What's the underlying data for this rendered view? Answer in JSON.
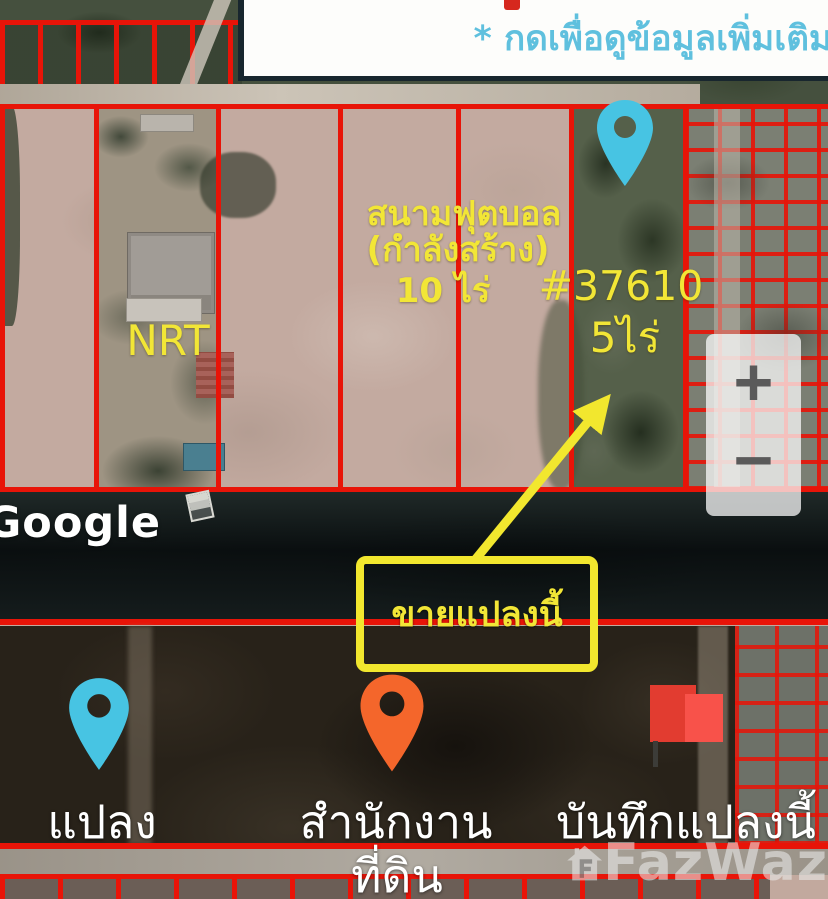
{
  "banner": {
    "instruction": "* กดเพื่อดูข้อมูลเพิ่มเติม"
  },
  "map_labels": {
    "field_name": "สนามฟุตบอล",
    "field_status": "(กำลังสร้าง)",
    "field_area": "10 ไร่",
    "plot_id": "#37610",
    "plot_area": "5ไร่",
    "nrt": "NRT"
  },
  "callout": {
    "text": "ขายแปลงนี้"
  },
  "zoom_control": {
    "zoom_in": "+",
    "zoom_out": "−"
  },
  "google_watermark": "Google",
  "legend": {
    "plot": {
      "label": "แปลง"
    },
    "land_office": {
      "label_line1": "สำนักงาน",
      "label_line2": "ที่ดิน"
    },
    "saved_plot": {
      "label": "บันทึกแปลงนี้"
    }
  },
  "brand_watermark": {
    "name": "FazWaz"
  },
  "colors": {
    "boundary_red": "#e81408",
    "annotation_yellow": "#f2e636",
    "banner_text_blue": "#5fc0de",
    "pin_blue": "#47c4e3",
    "pin_orange": "#f4662b",
    "flag_red": "#f8524a",
    "water_dark": "#151c1e",
    "dirt_tan": "#c3aaa0"
  }
}
